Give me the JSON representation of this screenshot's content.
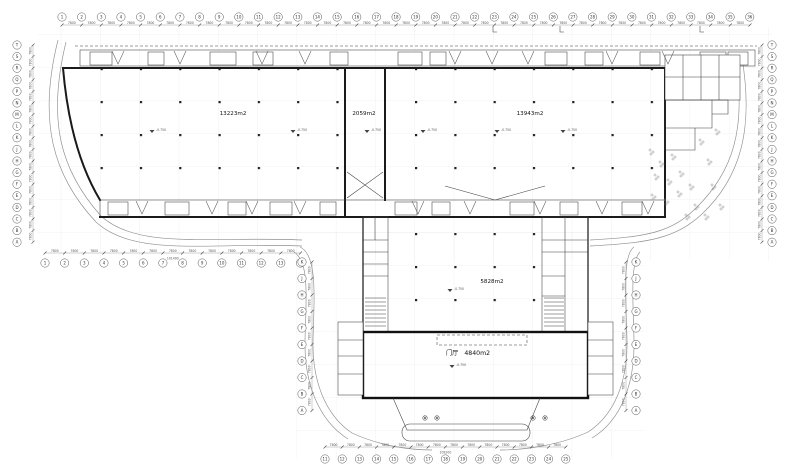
{
  "drawing": {
    "rooms": {
      "hall_left": {
        "area": "13223m2"
      },
      "hall_middle": {
        "area": "2059m2"
      },
      "hall_right": {
        "area": "13943m2"
      },
      "wing_hall": {
        "area": "5828m2"
      },
      "lobby": {
        "name": "门厅",
        "area": "4840m2"
      }
    },
    "elevation_marker": "-0.750",
    "grid": {
      "top": [
        "1",
        "2",
        "3",
        "4",
        "5",
        "6",
        "7",
        "8",
        "9",
        "10",
        "11",
        "12",
        "13",
        "14",
        "15",
        "16",
        "17",
        "18",
        "19",
        "20",
        "21",
        "22",
        "23",
        "24",
        "25",
        "26",
        "27",
        "28",
        "29",
        "30",
        "31",
        "32",
        "33",
        "34",
        "35",
        "36"
      ],
      "left": [
        "T",
        "S",
        "R",
        "Q",
        "P",
        "N",
        "M",
        "L",
        "K",
        "J",
        "H",
        "G",
        "F",
        "E",
        "D",
        "C",
        "B",
        "A"
      ],
      "right": [
        "T",
        "S",
        "R",
        "Q",
        "P",
        "N",
        "M",
        "L",
        "K",
        "J",
        "H",
        "G",
        "F",
        "E",
        "D",
        "C",
        "B",
        "A"
      ],
      "bottom_left": [
        "1",
        "2",
        "3",
        "4",
        "5",
        "6",
        "7",
        "8",
        "9",
        "10",
        "11",
        "12",
        "13",
        "14"
      ],
      "bottom_center": [
        "11",
        "12",
        "13",
        "14",
        "15",
        "16",
        "17",
        "18",
        "19",
        "20",
        "21",
        "22",
        "23",
        "24",
        "25"
      ],
      "wing_left": [
        "K",
        "J",
        "H",
        "G",
        "F",
        "E",
        "D",
        "C",
        "B",
        "A"
      ],
      "wing_right": [
        "K",
        "J",
        "H",
        "G",
        "F",
        "E",
        "D",
        "C",
        "B",
        "A"
      ]
    },
    "dimensions": {
      "bay": "7800",
      "bottom_left_total": "101400",
      "bottom_center_total": "109200"
    }
  },
  "colors": {
    "background": "#ffffff",
    "wall": "#1a1a1a",
    "line": "#3c3c3c",
    "grid": "#e4e4e4",
    "road": "#8f8f8f",
    "text": "#222222"
  }
}
